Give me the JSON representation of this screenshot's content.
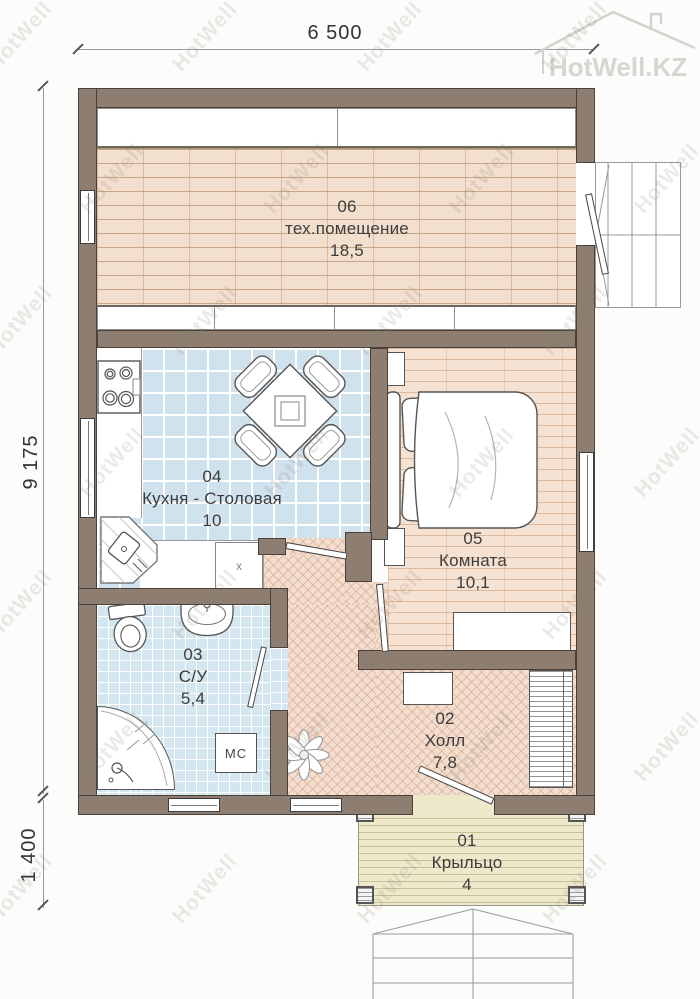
{
  "watermark": {
    "text": "HotWell",
    "logo_text": "HotWell.KZ"
  },
  "dimensions": {
    "width_top": "6 500",
    "height_left": "9 175",
    "porch_height_left": "1 400"
  },
  "rooms": [
    {
      "number": "06",
      "name": "тех.помещение",
      "area": "18,5"
    },
    {
      "number": "04",
      "name": "Кухня - Столовая",
      "area": "10"
    },
    {
      "number": "05",
      "name": "Комната",
      "area": "10,1"
    },
    {
      "number": "03",
      "name": "С/У",
      "area": "5,4"
    },
    {
      "number": "02",
      "name": "Холл",
      "area": "7,8"
    },
    {
      "number": "01",
      "name": "Крыльцо",
      "area": "4"
    }
  ],
  "labels": {
    "washing_machine": "МС",
    "kitchen_cabinet": "x"
  },
  "colors": {
    "wall": "#8d7e71",
    "line": "#4a4238",
    "wood": "#f2dfcd",
    "kitchen": "#cfe2ee",
    "bath": "#d4e6ef",
    "bedroom": "#f6e2d3",
    "hall": "#f3ded0",
    "porch": "#efe9cb",
    "label": "#3d3d3d"
  }
}
